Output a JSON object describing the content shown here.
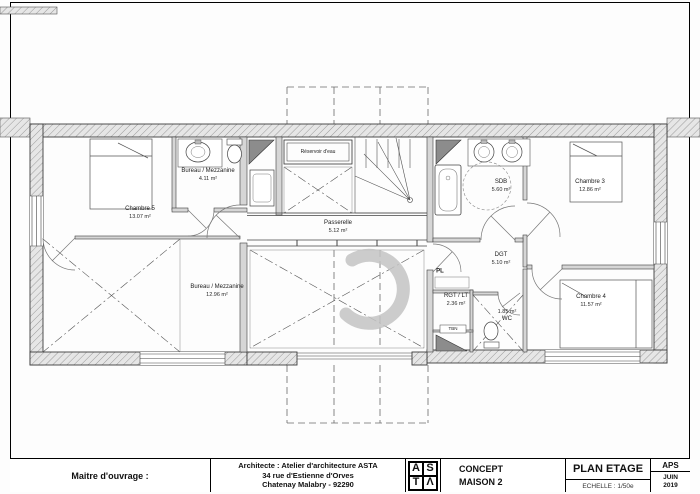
{
  "title_block": {
    "maitre_label": "Maitre d'ouvrage :",
    "architect_line1": "Architecte : Atelier d'architecture ASTA",
    "architect_line2": "34 rue d'Estienne d'Orves",
    "architect_line3": "Chatenay Malabry - 92290",
    "logo_letters": [
      "A",
      "S",
      "T",
      "Λ"
    ],
    "project_line1": "CONCEPT",
    "project_line2": "MAISON 2",
    "sheet_title": "PLAN ETAGE",
    "scale": "ECHELLE : 1/50e",
    "phase": "APS",
    "date_line1": "JUIN",
    "date_line2": "2019"
  },
  "rooms": {
    "chambre5": {
      "name": "Chambre 5",
      "area": "13.07 m²"
    },
    "bureau_s": {
      "name": "Bureau / Mezzanine",
      "area": "4.11 m²"
    },
    "bureau_l": {
      "name": "Bureau / Mezzanine",
      "area": "12.96 m²"
    },
    "reservoir": {
      "name": "Réservoir d'eau"
    },
    "passerelle": {
      "name": "Passerelle",
      "area": "5.12 m²"
    },
    "sdb": {
      "name": "SDB",
      "area": "5.60 m²"
    },
    "chambre3": {
      "name": "Chambre 3",
      "area": "12.86 m²"
    },
    "dgt": {
      "name": "DGT",
      "area": "5.10 m²"
    },
    "pl": {
      "name": "PL"
    },
    "rgt": {
      "name": "RGT / LT",
      "area": "2.36 m²"
    },
    "tbn": {
      "name": "TBN"
    },
    "wc": {
      "name": "WC",
      "area": "1.85 m²"
    },
    "chambre4": {
      "name": "Chambre 4",
      "area": "11.57 m²"
    }
  },
  "colors": {
    "wall_hatch": "#9a9a9a",
    "wall_fill": "#e4e4e4",
    "line": "#2e2e2e",
    "dashed": "#666666",
    "dark_fixture": "#8c8c8c"
  }
}
